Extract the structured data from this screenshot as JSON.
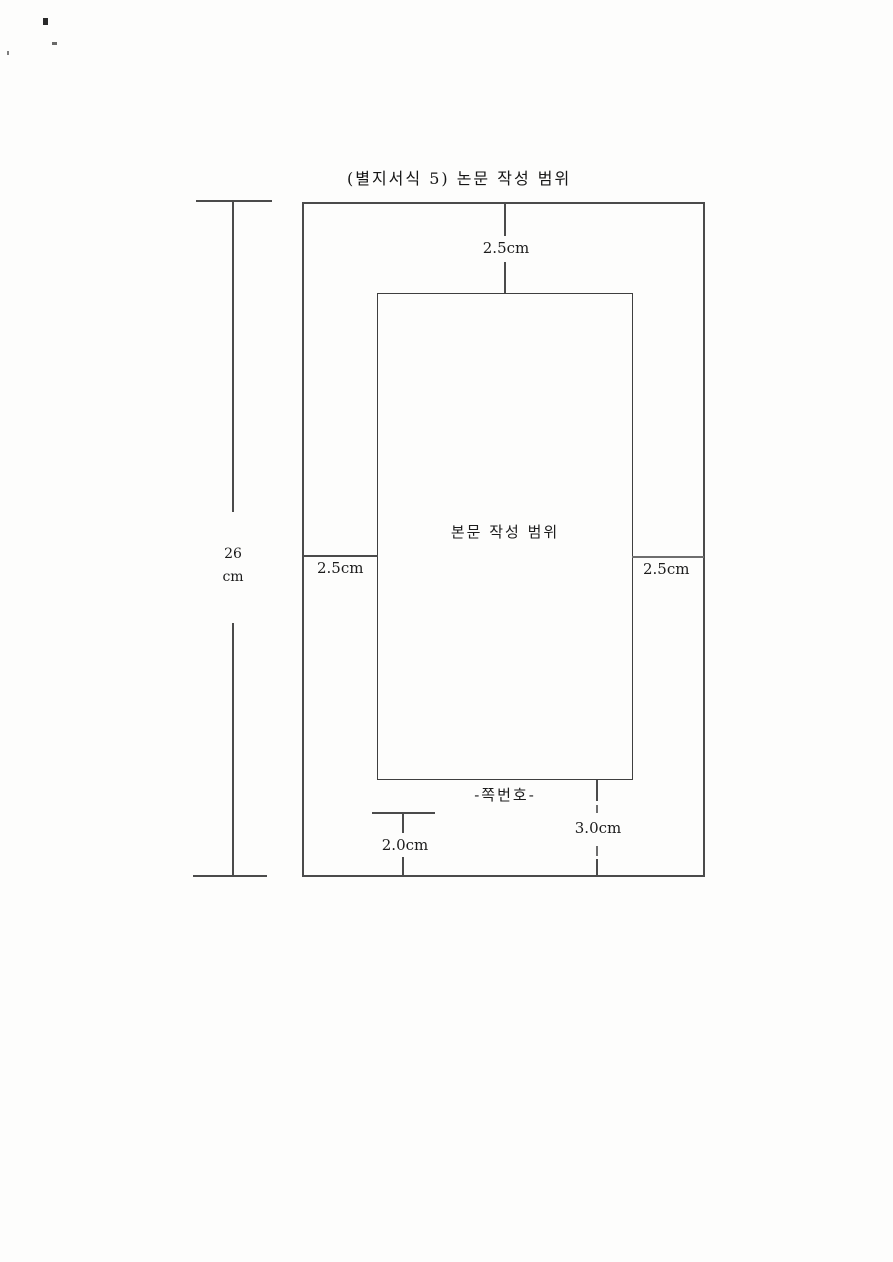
{
  "page": {
    "title": "(별지서식 5) 논문 작성 범위"
  },
  "diagram": {
    "body_area_label": "본문 작성 범위",
    "page_number_label": "-쪽번호-",
    "dimensions": {
      "top_margin": "2.5cm",
      "left_margin": "2.5cm",
      "right_margin": "2.5cm",
      "bottom_margin": "3.0cm",
      "page_number_offset": "2.0cm",
      "page_height_value": "26",
      "page_height_unit": "cm"
    }
  }
}
